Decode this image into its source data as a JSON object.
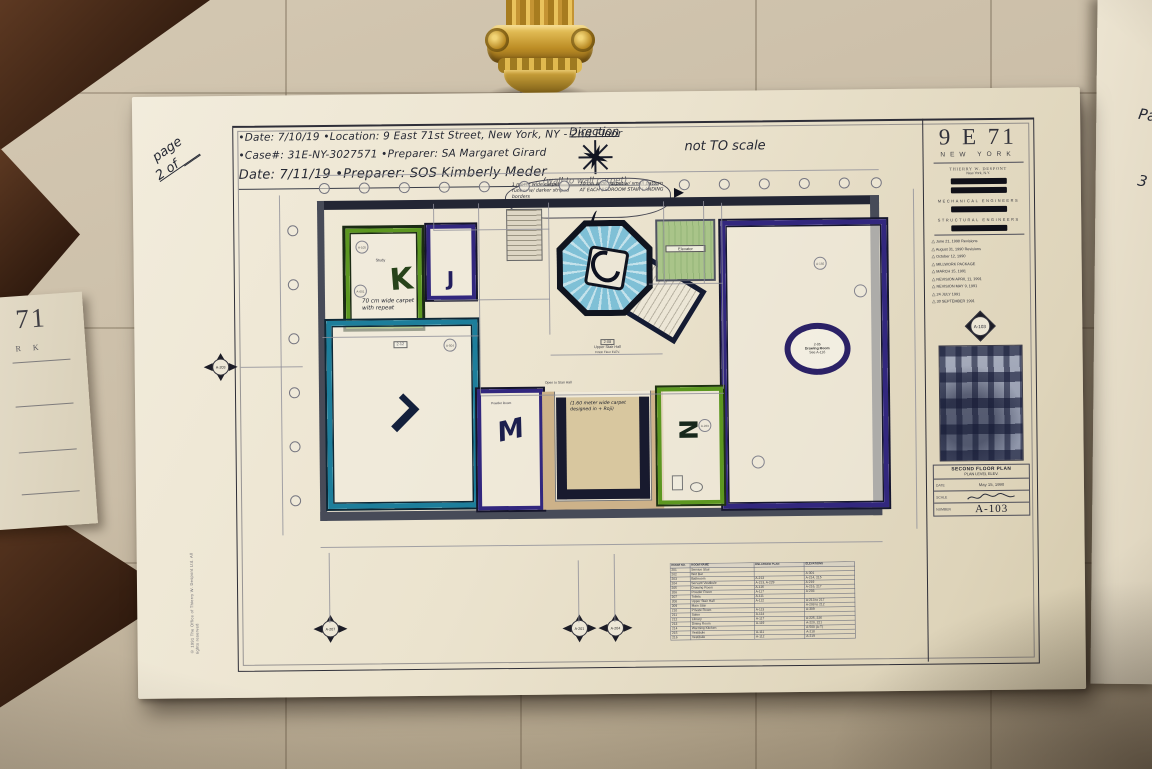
{
  "colors": {
    "marker_green": "#5c9720",
    "marker_purple": "#32277e",
    "marker_teal": "#1d7e9b",
    "marker_navy": "#141b33",
    "stair_blue": "#7fc0d6",
    "stair_tan": "#c9ab80",
    "elevator_green": "#a9c489",
    "ornament_gold": "#c49433",
    "inlay_brown": "#462817"
  },
  "handwritten": {
    "page_word": "page",
    "page_num": "2 of ___",
    "line1": "•Date: 7/10/19   •Location: 9 East 71st Street, New York, NY - 2nd Floor",
    "line2": "•Case#: 31E-NY-3027571   •Preparer: SA Margaret Girard",
    "line3": "Date: 7/11/19   •Preparer: SOS Kimberly Meder",
    "direction": "Direction",
    "wall_to_wall": "(wall to wall carpet)",
    "not_to_scale": "not TO scale",
    "cloud_left": "1 meter wide carpet runner w/ darker striped borders",
    "cloud_right": "70 cm wide carpet w/ small pattern AT EACH BEDROOM STAIR LANDING",
    "room_k_note": "70 cm wide carpet with repeat",
    "stair_note": "(1.60 meter wide carpet designed in + Roji)"
  },
  "plan": {
    "letters": {
      "k": "K",
      "j": "J",
      "l": "L",
      "m": "M",
      "n": "N"
    },
    "labels": {
      "elevator": "Elevator",
      "study": "Study",
      "powder_room": "Powder Room",
      "drawing_room_tag": "2-05",
      "drawing_room": "Drawing Room",
      "drawing_room_ref": "See A-116",
      "upper_hall_tag": "2-08",
      "upper_hall": "Upper Stair Hall",
      "upper_hall_sub": "Finish Floor ELEV.",
      "open_to": "Open to Stair Hall",
      "left_room_tag": "2-12"
    },
    "tags": [
      "A-105",
      "A-601",
      "A-192",
      "A-504",
      "A-223"
    ],
    "markers": {
      "left": "A-203",
      "b1": "A-207",
      "b2": "A-201",
      "b3": "A-204"
    }
  },
  "schedule": {
    "headers": [
      "ROOM NO.",
      "ROOM NAME",
      "ENLARGED PLAN",
      "ELEVATIONS"
    ],
    "rows": [
      [
        "201",
        "Service Stair",
        "",
        ""
      ],
      [
        "202",
        "Wet Bar",
        "",
        "A-301"
      ],
      [
        "203",
        "Bathroom",
        "A-213",
        "A-214, 215"
      ],
      [
        "204",
        "Servant Vestibule",
        "A-213, A-229",
        "A-219"
      ],
      [
        "205",
        "Drawing Room",
        "A-116",
        "A-216, 217"
      ],
      [
        "206",
        "Powder Room",
        "A-117",
        "A-203"
      ],
      [
        "207",
        "Toilets",
        "A-111",
        ""
      ],
      [
        "208",
        "Upper Stair Hall",
        "A-112",
        "A-213 to 217"
      ],
      [
        "209",
        "Main Stair",
        "",
        "A-208 to 212"
      ],
      [
        "210",
        "Private Room",
        "A-113",
        "A-309"
      ],
      [
        "211",
        "Salon",
        "A-114",
        ""
      ],
      [
        "212",
        "Library",
        "A-117",
        "A-225, 226"
      ],
      [
        "213",
        "Dining Room",
        "A-119",
        "A-220, 221"
      ],
      [
        "214",
        "Warming Kitchen",
        "",
        "A-500 (A-T)"
      ],
      [
        "215",
        "Vestibule",
        "A-111",
        "A-218"
      ],
      [
        "216",
        "Vestibule",
        "A-112",
        "A-219"
      ]
    ]
  },
  "titleblock": {
    "project": "9 E 71",
    "city": "NEW YORK",
    "architect": "THIERRY W. DESPONT",
    "architect_city": "New York, N.Y.",
    "mech_heading": "MECHANICAL ENGINEERS",
    "struct_heading": "STRUCTURAL ENGINEERS",
    "revisions": [
      "June 21, 1990 Revisions",
      "August 31, 1990 Revisions",
      "October 12, 1990",
      "MILLWORK PACKAGE",
      "MARCH 15, 1991",
      "REVISION APRIL 11, 1991",
      "REVISION MAY 9, 1991",
      "24 JULY 1991",
      "30 SEPTEMBER 1991"
    ],
    "sheet_marker": "A-103",
    "drawing_title": "SECOND FLOOR PLAN",
    "drawing_sub": "PLAN LEVEL ELEV.",
    "date_label": "DATE",
    "date_value": "May 15, 1990",
    "scale_label": "SCALE",
    "number_label": "NUMBER",
    "number_value": "A-103",
    "copyright": "© 1991 The Office of Thierry W. Despont Ltd. All rights reserved"
  },
  "fragments": {
    "left_big": "71",
    "left_small": "R K",
    "right_line1": "Pa",
    "right_line2": "3"
  }
}
